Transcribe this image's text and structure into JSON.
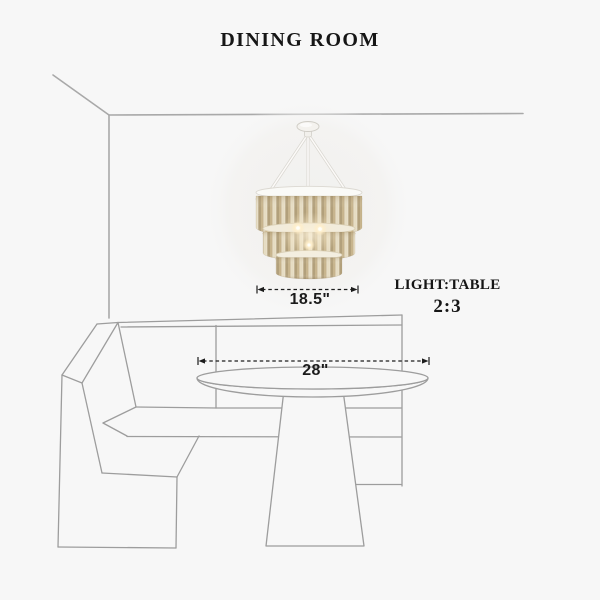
{
  "page": {
    "background_color": "#f7f7f7",
    "kind": "product dimension diagram"
  },
  "title": "DINING ROOM",
  "dimensions": {
    "chandelier_width": "18.5\"",
    "table_width": "28\""
  },
  "ratio_annotation": {
    "caption": "LIGHT:TABLE",
    "value": "2:3"
  },
  "colors": {
    "ink": "#1b1b1b",
    "wall_line": "#a9a9a9",
    "sketch_line": "#9d9d9d",
    "chandelier_frame_white": "#fafaf7",
    "chandelier_rod_champagne": "#c7b48d",
    "chandelier_band_gold": "#e3d2ab",
    "bulb_glow": "#ffeec9"
  },
  "scene_elements": {
    "room": "room corner wall lines",
    "light": "three-tier champagne crystal-rod chandelier with white canopy and cords",
    "seating": "L-shaped corner bench sketch",
    "table": "round pedestal dining table sketch"
  }
}
